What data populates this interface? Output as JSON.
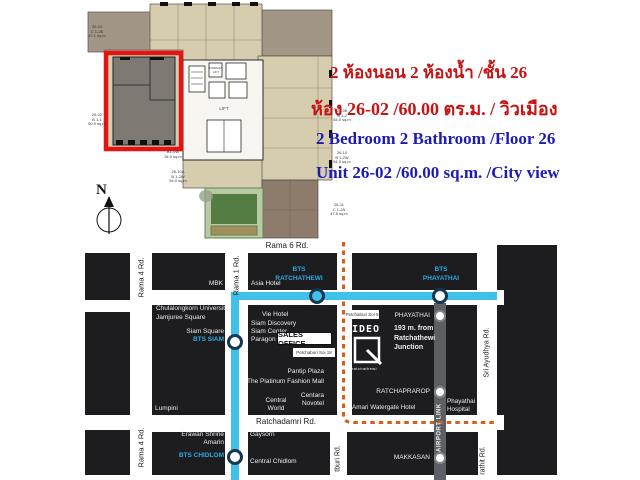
{
  "listing": {
    "thai_line1": "2 ห้องนอน 2 ห้องน้ำ /ชั้น 26",
    "thai_line2": "ห้อง 26-02 /60.00 ตร.ม. / วิวเมือง",
    "eng_line1": "2 Bedroom 2 Bathroom /Floor 26",
    "eng_line2": "Unit 26-02 /60.00 sq.m. /City view"
  },
  "colors": {
    "highlight_red": "#e51414",
    "text_red": "#c41414",
    "text_blue": "#1c1cb4",
    "bts_blue": "#3fc1e9",
    "bts_label_blue": "#2da9e0",
    "orange_route": "#d2601f",
    "block_black": "#1d1d20",
    "arl_gray": "#5c6064"
  },
  "floorplan": {
    "compass": "N",
    "fireman_lift": "FIREMAN\nLIFT",
    "lift": "LIFT",
    "units": {
      "u2603": "26-03\nC 1-2B\n47.1 sq.m",
      "u2602": "26-02\nB 1-1\n60.0 sq.m",
      "b10w": "B1-0W\n34.0 sq.m",
      "u2610a": "26-10A\nB 1-2W\n54.0 sq.m",
      "u2608": "26-08\nB 1-2\n54.0 sq.m",
      "u2610": "26-10\nB 1-2W\n54.0 sq.m",
      "u2611": "26-11\nC 1-2A\n47.5 sq.m"
    }
  },
  "map": {
    "roads": {
      "rama6": "Rama 6 Rd.",
      "rama4_upper": "Rama 4 Rd.",
      "rama4_lower": "Rama 4 Rd.",
      "rama1": "Rama 1 Rd.",
      "ratchadamri": "Ratchadamri Rd.",
      "petchburi": "tburi Rd.",
      "sri_ayudhya": "Sri Ayudhya Rd.",
      "rathit": "rathit Rd."
    },
    "bts": {
      "ratchathewi_l1": "BTS",
      "ratchathewi_l2": "RATCHATHEWI",
      "phayathai_l1": "BTS",
      "phayathai_l2": "PHAYATHAI",
      "siam": "BTS SIAM",
      "chidlom": "BTS CHIDLOM"
    },
    "arl": {
      "label": "AIRPORT LINK",
      "phayathai": "PHAYATHAI",
      "ratchaprarop": "RATCHAPRAROP",
      "makkasan": "MAKKASAN"
    },
    "places": {
      "mbk": "MBK",
      "asia_hotel": "Asia Hotel",
      "chula": "Chulalongkorn University",
      "jamjuree": "Jamjuree Square",
      "siam_square": "Siam Square",
      "vie_hotel": "Vie Hotel",
      "siam_discovery": "Siam Discovery",
      "siam_center": "Siam Center",
      "paragon": "Paragon",
      "pantip": "Pantip Plaza",
      "platinum": "The Platinum Fashion Mall",
      "centara": "Centara\nNovotel",
      "central_world": "Central\nWorld",
      "lumpini": "Lumpini",
      "erawan": "Erawan Shrine\nAmarin",
      "gaysorn": "Gaysorn",
      "central_chidlom": "Central Chidlom",
      "amari": "Amari Watergate Hotel",
      "phayathai_hospital": "Phayathai\nHospital"
    },
    "sales_office": "SALES OFFICE",
    "soi18": "Petchaburi Soi 18",
    "soi9": "Petchaburi Soi 9",
    "project": {
      "brand": "IDEO",
      "sub": "ratchathewi",
      "distance": "193 m. from\nRatchathewi\nJunction"
    }
  }
}
